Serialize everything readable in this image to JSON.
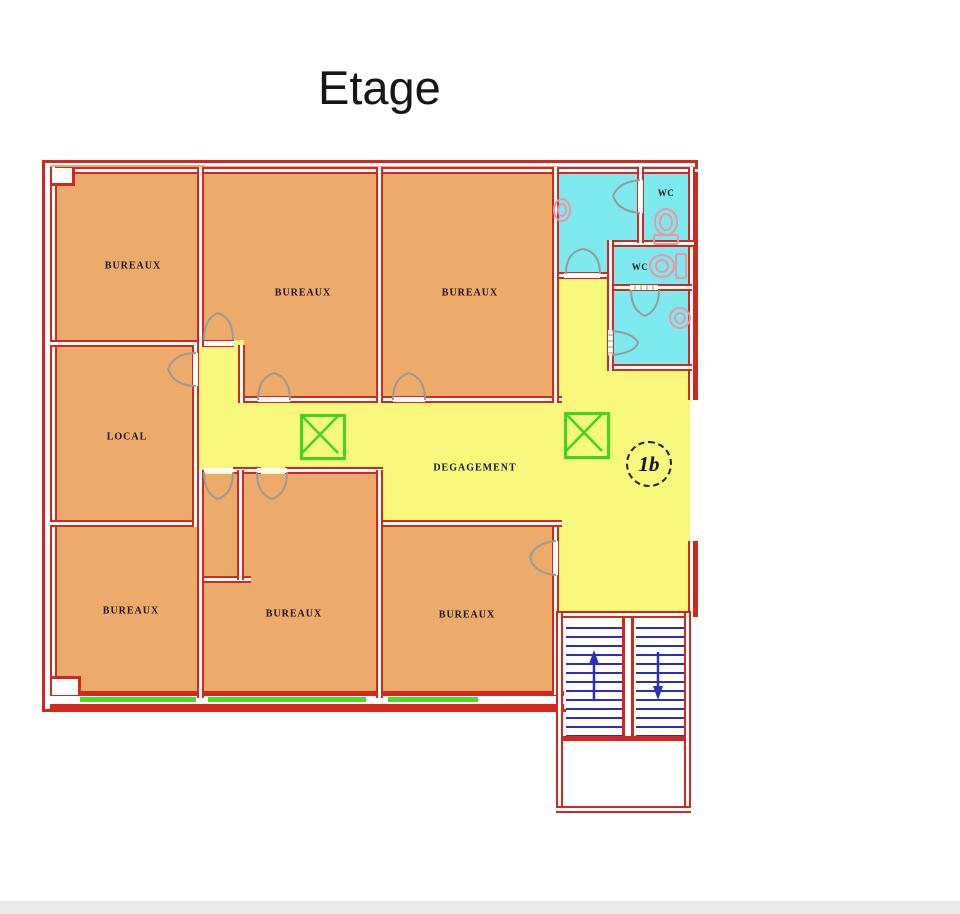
{
  "page": {
    "title": "Etage"
  },
  "plan": {
    "labels": {
      "bureaux": "BUREAUX",
      "local": "LOCAL",
      "corridor": "DEGAGEMENT",
      "wc": "WC",
      "unit_marker": "1b"
    },
    "colors": {
      "wall_red": "#d3281e",
      "office_fill": "#ecaa6b",
      "corridor_fill": "#f8f87d",
      "sanitary_fill": "#7deaf0",
      "window_green": "#52d629",
      "marker_green": "#3fd61f",
      "stairs_blue": "#2a2ebd",
      "fixture_pink": "#f093a3",
      "door_gray": "#9a9a95"
    }
  }
}
